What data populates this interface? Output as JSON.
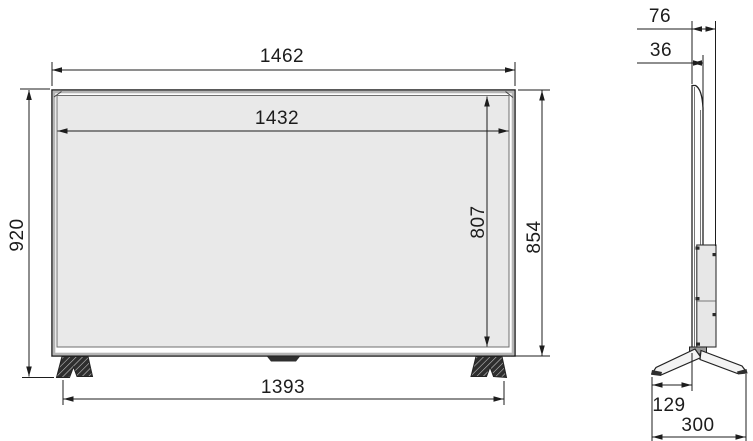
{
  "drawing": {
    "type": "tv-dimension-diagram",
    "front_view": {
      "overall_width": "1462",
      "screen_width": "1432",
      "overall_height": "920",
      "panel_height": "854",
      "screen_height": "807",
      "stand_feet_span": "1393"
    },
    "side_view": {
      "overall_depth": "76",
      "panel_depth": "36",
      "foot_front_offset": "129",
      "stand_depth": "300"
    },
    "colors": {
      "line": "#1d1d1d",
      "screen_fill": "#e9e9e9",
      "frame_gray": "#b5b5b5",
      "bulge_fill": "#e7e7e7",
      "foot_dark": "#2e2e2e",
      "background": "#ffffff"
    }
  }
}
